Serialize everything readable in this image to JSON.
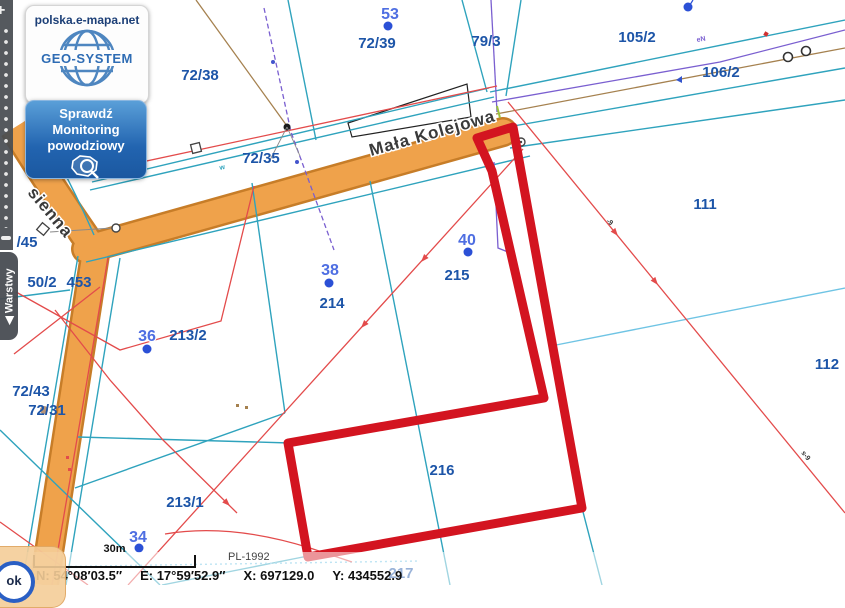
{
  "branding": {
    "site": "polska.e-mapa.net",
    "logo_text": "GEO-SYSTEM",
    "flood_button_lines": [
      "Sprawdź",
      "Monitoring",
      "powodziowy"
    ]
  },
  "left_toolbar": {
    "zoom_in": "+",
    "layers_tab": "◀ Warstwy"
  },
  "statusbar": {
    "scale_label": "30m",
    "crs": "PL-1992",
    "coord_n": "N: 54°08′03.5″",
    "coord_e": "E: 17°59′52.9″",
    "coord_x": "X: 697129.0",
    "coord_y": "Y: 434552.9",
    "ok_label": "ok"
  },
  "colors": {
    "highlight_red": "#d31420",
    "road_fill": "#efa24b",
    "road_casing": "#c77d28",
    "parcel_label_blue": "#1d55a8",
    "address_label_blue": "#4e6ee2",
    "address_dot_blue": "#2b50d6",
    "boundary_teal": "#2fa3bd",
    "boundary_light_blue": "#6fc4e4",
    "utility_red": "#e34b4b",
    "utility_purple": "#7a5fd0",
    "utility_brown": "#a5814f",
    "toolbar_gray": "#484c52"
  },
  "map": {
    "street_names": [
      {
        "text": "Mała Kolejowa",
        "x": 371,
        "y": 156,
        "rot": -15.7,
        "size": 17
      },
      {
        "text": "sienna",
        "x": 27,
        "y": 193,
        "rot": 50,
        "size": 15
      }
    ],
    "parcel_labels": [
      {
        "text": "72/38",
        "x": 200,
        "y": 80
      },
      {
        "text": "72/39",
        "x": 377,
        "y": 48
      },
      {
        "text": "72/35",
        "x": 261,
        "y": 163
      },
      {
        "text": "79/3",
        "x": 486,
        "y": 46
      },
      {
        "text": "105/2",
        "x": 637,
        "y": 42
      },
      {
        "text": "106/2",
        "x": 721,
        "y": 77
      },
      {
        "text": "111",
        "x": 705,
        "y": 209
      },
      {
        "text": "112",
        "x": 827,
        "y": 369
      },
      {
        "text": "215",
        "x": 457,
        "y": 280
      },
      {
        "text": "214",
        "x": 332,
        "y": 308
      },
      {
        "text": "216",
        "x": 442,
        "y": 475
      },
      {
        "text": "217",
        "x": 401,
        "y": 578
      },
      {
        "text": "213/2",
        "x": 188,
        "y": 340
      },
      {
        "text": "213/1",
        "x": 185,
        "y": 507
      },
      {
        "text": "453",
        "x": 79,
        "y": 287
      },
      {
        "text": "50/2",
        "x": 42,
        "y": 287
      },
      {
        "text": "/45",
        "x": 27,
        "y": 247
      },
      {
        "text": "72/43",
        "x": 31,
        "y": 396
      },
      {
        "text": "72/31",
        "x": 47,
        "y": 415
      }
    ],
    "address_points": [
      {
        "text": "53",
        "x": 390,
        "y": 19,
        "dot_x": 388,
        "dot_y": 26
      },
      {
        "text": "38",
        "x": 330,
        "y": 275,
        "dot_x": 329,
        "dot_y": 283
      },
      {
        "text": "40",
        "x": 467,
        "y": 245,
        "dot_x": 468,
        "dot_y": 252
      },
      {
        "text": "36",
        "x": 147,
        "y": 341,
        "dot_x": 147,
        "dot_y": 349
      },
      {
        "text": "34",
        "x": 138,
        "y": 542,
        "dot_x": 139,
        "dot_y": 548
      },
      {
        "text": "",
        "x": 688,
        "y": 4,
        "dot_x": 688,
        "dot_y": 7
      }
    ],
    "tiny_labels": [
      {
        "text": "-9",
        "x": 606,
        "y": 222,
        "rot": 35,
        "color": "#333333"
      },
      {
        "text": "s-9",
        "x": 801,
        "y": 453,
        "rot": 51,
        "color": "#333333"
      },
      {
        "text": "eN",
        "x": 697,
        "y": 42,
        "rot": -10,
        "color": "#7a5fd0"
      },
      {
        "text": "w",
        "x": 220,
        "y": 170,
        "rot": -13,
        "color": "#2fa3bd"
      }
    ]
  }
}
